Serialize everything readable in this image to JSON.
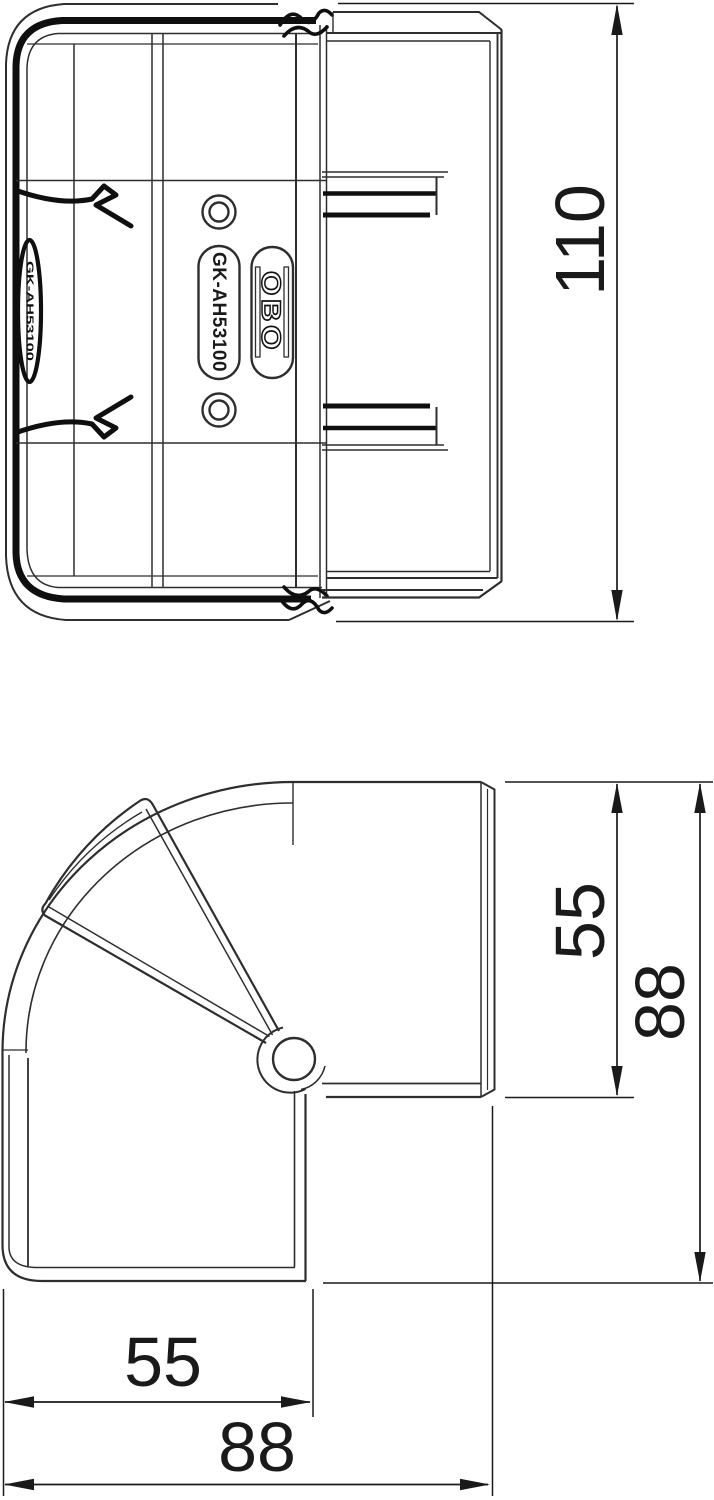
{
  "product": {
    "model_label": "GK-AH53100",
    "brand_label": "OBO",
    "side_stamp_label": "GK-AH53100"
  },
  "dimensions": {
    "height": {
      "value": "110",
      "unit": "mm"
    },
    "depth_inner": {
      "value": "55",
      "unit": "mm"
    },
    "depth_overall": {
      "value": "88",
      "unit": "mm"
    },
    "width_inner": {
      "value": "55",
      "unit": "mm"
    },
    "width_overall": {
      "value": "88",
      "unit": "mm"
    }
  },
  "colors": {
    "background": "#ffffff",
    "line": "#2e2e2e",
    "dark": "#0f0f0f",
    "dimension": "#1a1a1a"
  }
}
